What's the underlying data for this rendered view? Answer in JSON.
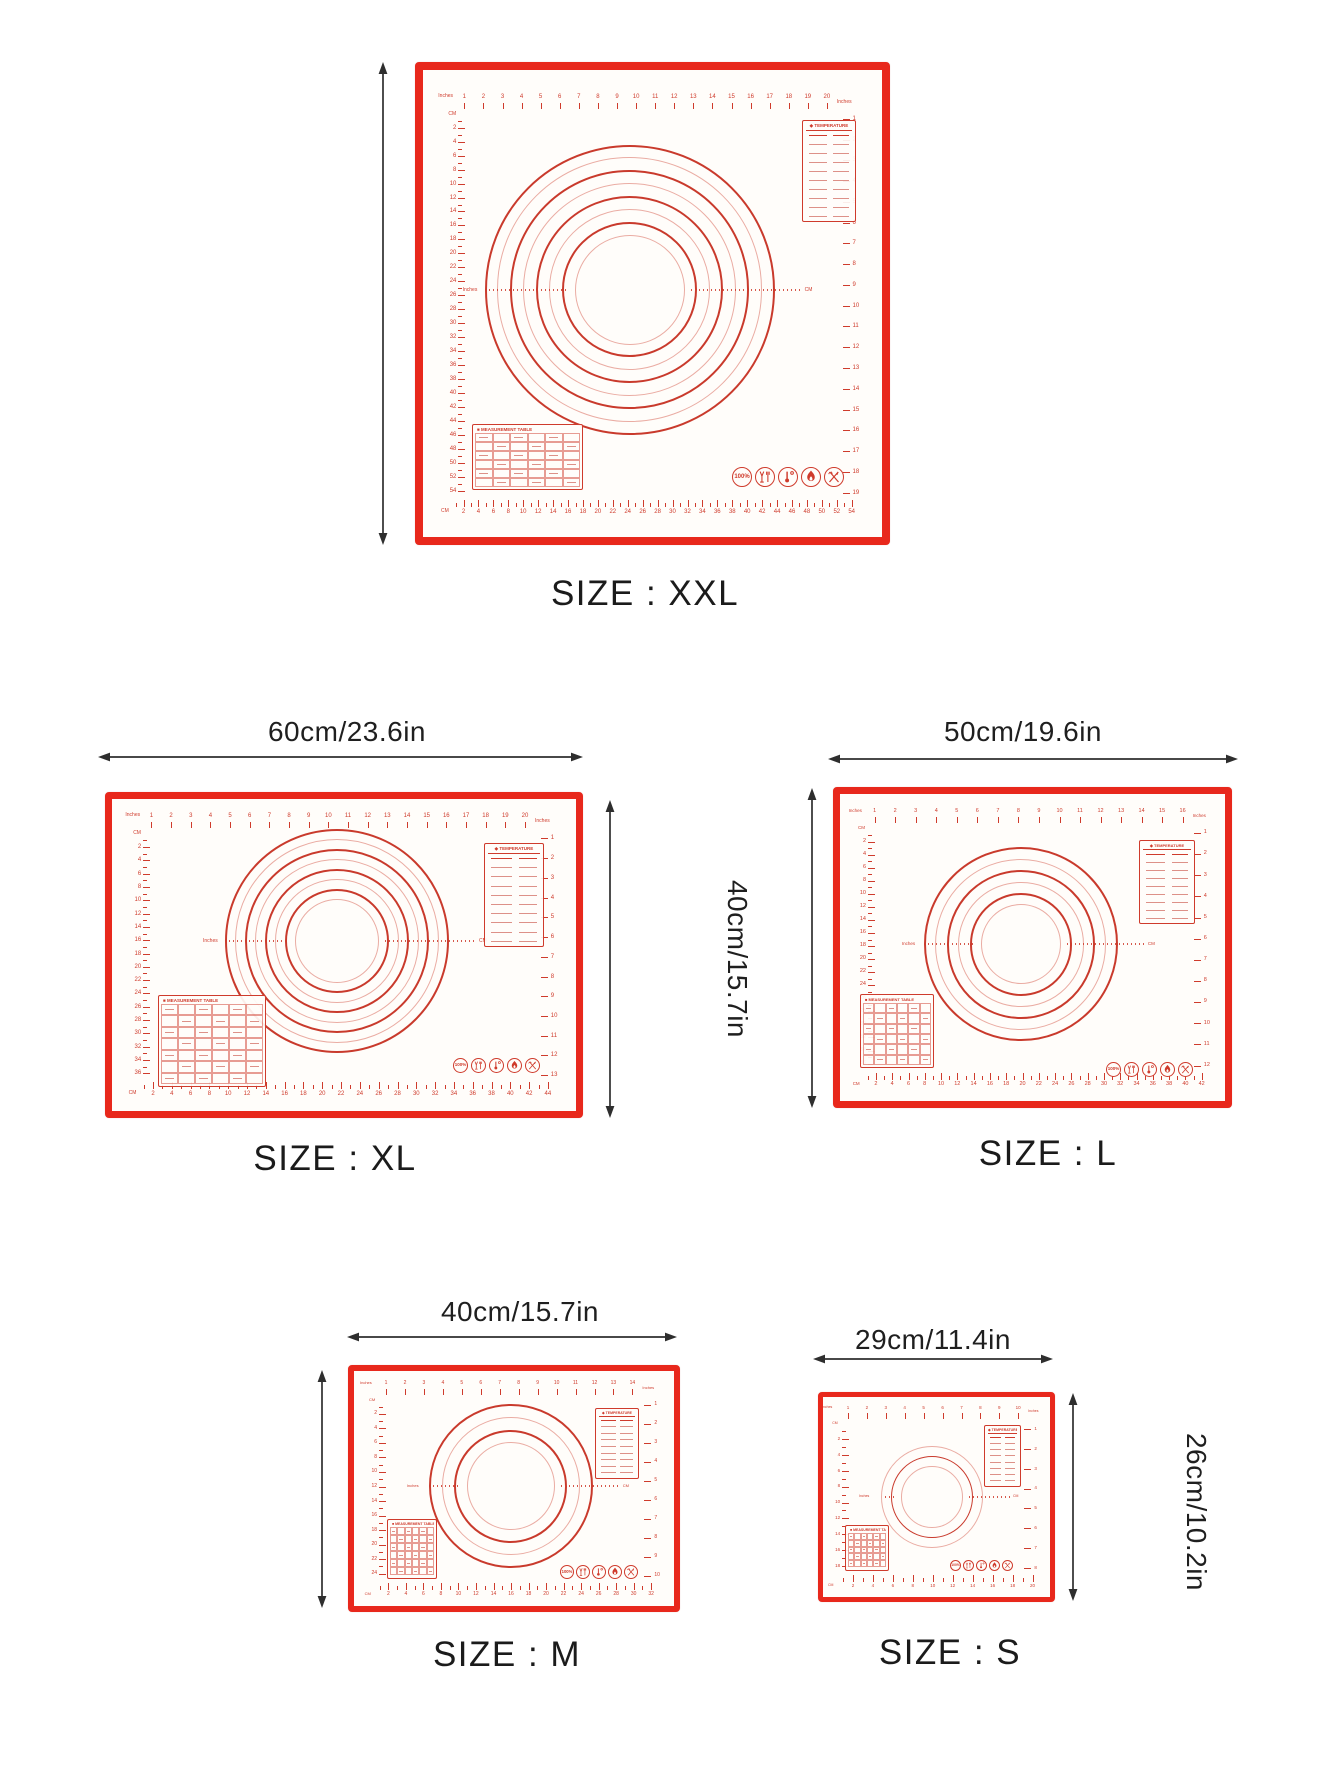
{
  "page_title": "Pastry mat size chart",
  "colors": {
    "mat_border_red": "#e8281c",
    "marking_red": "#cf3b2c",
    "ring_dark": "#c93a2c",
    "ring_light": "#eaaca3",
    "mat_surface": "#fffdfa",
    "arrow_black": "#2e2e2e",
    "label_text": "#1b1b1b"
  },
  "ruler_units": {
    "inches": "Inches",
    "cm": "CM"
  },
  "tables": {
    "temperature_title": "TEMPERATURE",
    "measurement_title": "MEASUREMENT TABLE"
  },
  "icons": [
    {
      "name": "badge-100-icon",
      "label": "100%"
    },
    {
      "name": "food-safe-icon",
      "label": ""
    },
    {
      "name": "heat-thermometer-icon",
      "label": ""
    },
    {
      "name": "flame-icon",
      "label": ""
    },
    {
      "name": "utensils-icon",
      "label": ""
    }
  ],
  "mats": {
    "xxl": {
      "size_label": "SIZE : XXL",
      "height_label": "60cm/23.6in",
      "rings": 8,
      "rulers": {
        "top_max": 20,
        "right_max": 19,
        "bottom_max": 54,
        "left_max": 54
      }
    },
    "xl": {
      "size_label": "SIZE : XL",
      "width_label": "60cm/23.6in",
      "height_label": "40cm/15.7in",
      "rings": 8,
      "rulers": {
        "top_max": 20,
        "right_max": 13,
        "bottom_max": 44,
        "left_max": 36
      }
    },
    "l": {
      "size_label": "SIZE : L",
      "width_label": "50cm/19.6in",
      "height_label": "40cm/15.7in",
      "rings": 6,
      "rulers": {
        "top_max": 16,
        "right_max": 12,
        "bottom_max": 42,
        "left_max": 36
      }
    },
    "m": {
      "size_label": "SIZE : M",
      "width_label": "40cm/15.7in",
      "height_label": "30cm/11.8in",
      "rings": 4,
      "rulers": {
        "top_max": 14,
        "right_max": 10,
        "bottom_max": 32,
        "left_max": 24
      }
    },
    "s": {
      "size_label": "SIZE : S",
      "width_label": "29cm/11.4in",
      "height_label": "26cm/10.2in",
      "rings": 3,
      "rulers": {
        "top_max": 10,
        "right_max": 8,
        "bottom_max": 20,
        "left_max": 18
      }
    }
  }
}
